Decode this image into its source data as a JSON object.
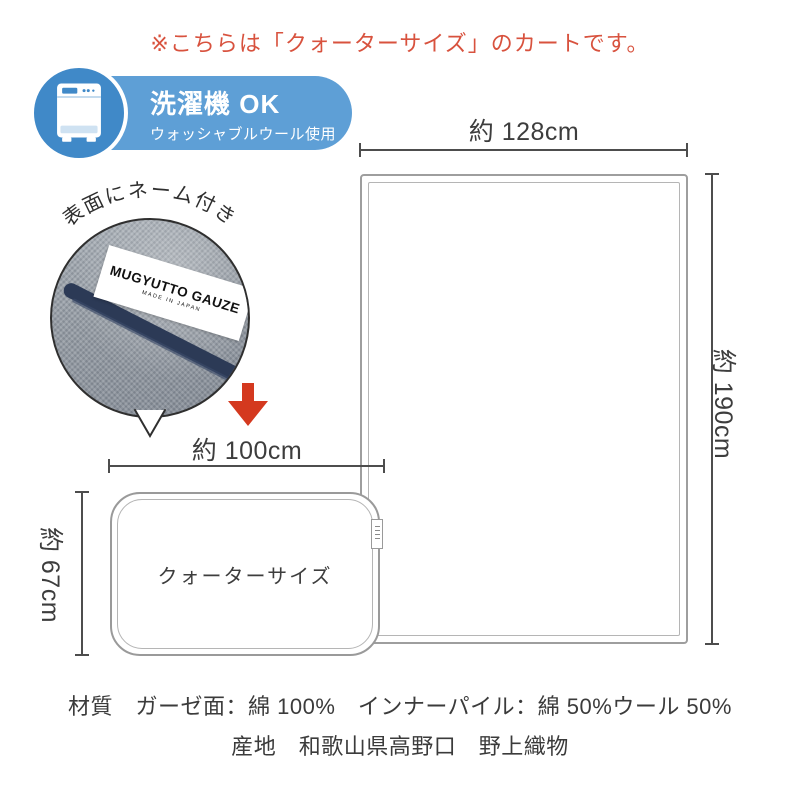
{
  "notice": {
    "text": "※こちらは「クォーターサイズ」のカートです。",
    "color": "#d8523e"
  },
  "badge": {
    "title": "洗濯機 OK",
    "subtitle": "ウォッシャブルウール使用",
    "pill_color": "#5e9fd6",
    "circle_color": "#4089c8",
    "icon": "washing-machine-icon"
  },
  "callout": {
    "arc_label": "表面にネーム付き",
    "tag_line1": "MUGYUTTO GAUZE",
    "tag_line2": "MADE IN JAPAN",
    "binding_color": "#2c3a56"
  },
  "diagram": {
    "arrow_color": "#d4391f",
    "full_blanket": {
      "width_label": "約 128cm",
      "height_label": "約 190cm"
    },
    "quarter_blanket": {
      "name": "クォーターサイズ",
      "width_label": "約 100cm",
      "height_label": "約 67cm"
    }
  },
  "footer": {
    "line1": "材質　ガーゼ面：綿 100%　インナーパイル：綿 50%ウール 50%",
    "line2": "産地　和歌山県高野口　野上織物"
  }
}
